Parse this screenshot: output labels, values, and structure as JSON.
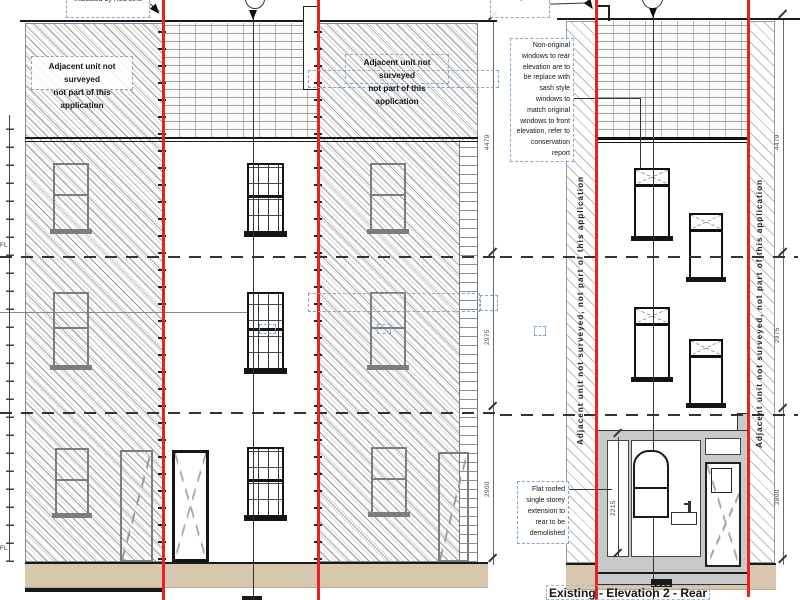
{
  "notes": {
    "site_boundary": "Site Boundary\nIndicated by Red Line",
    "adjacent_unit_l1": "Adjacent unit not surveyed",
    "adjacent_unit_l2": "not part of this application",
    "adjacent_unit_vertical": "Adjacent unit not surveyed, not part of this application",
    "window_note": "Non-original\nwindows to rear\nelevation are to\nbe replace with\nsash style\nwindows to\nmatch original\nwindows to front\nelevation, refer to\nconservation\nreport",
    "extension_note": "Flat roofed\nsingle storey\nextension to\nrear to be\ndemolished"
  },
  "dimensions": {
    "front": {
      "upper": "4479",
      "middle": "2975",
      "lower": "2900"
    },
    "rear": {
      "upper": "4479",
      "middle": "2975",
      "lower": "2800",
      "extension_height": "2215"
    }
  },
  "labels": {
    "floor_level": "FL",
    "title_rear": "Existing - Elevation 2 - Rear"
  },
  "colors": {
    "boundary_red": "#e8231e",
    "ground_band": "#d8c6ae",
    "annotation_dash_blue": "#7fa8cc",
    "extension_gray": "#c9c9c9"
  }
}
